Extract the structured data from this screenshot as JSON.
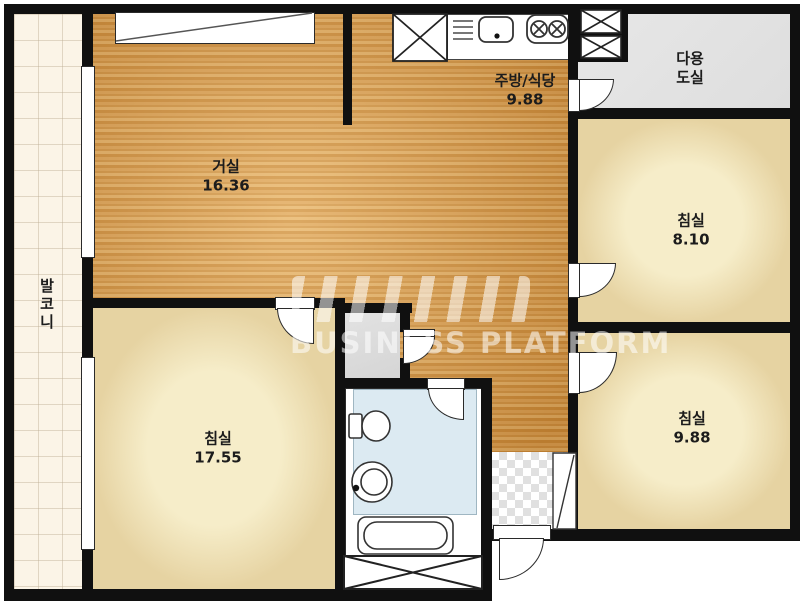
{
  "floorplan": {
    "watermark": {
      "brand_logo": "NHN",
      "brand_text": "BUSINESS PLATFORM"
    },
    "rooms": {
      "balcony": {
        "name": "발코니"
      },
      "living_room": {
        "name": "거실",
        "area": "16.36"
      },
      "kitchen_dining": {
        "name": "주방/식당",
        "area": "9.88"
      },
      "utility_room": {
        "name_line1": "다용",
        "name_line2": "도실"
      },
      "bedroom_right_top": {
        "name": "침실",
        "area": "8.10"
      },
      "bedroom_right_bottom": {
        "name": "침실",
        "area": "9.88"
      },
      "bedroom_left": {
        "name": "침실",
        "area": "17.55"
      }
    },
    "fixtures": [
      "wardrobe",
      "refrigerator-space",
      "range-hood",
      "kitchen-sink",
      "stove",
      "duct-shaft-upper",
      "duct-shaft-lower",
      "toilet",
      "wash-basin",
      "bathtub",
      "shoe-cabinet",
      "storage-closet",
      "entrance-door",
      "balcony-window-top",
      "balcony-window-bottom"
    ],
    "colors": {
      "wall": "#101010",
      "wood_floor": "#d79a47",
      "bedroom_floor": "#f0e3ba",
      "balcony_floor": "#fbf4e7",
      "utility_floor": "#e4e4e4",
      "bathroom_floor": "#dceaf2",
      "dressing_floor": "#dcdcdc",
      "entrance_checker": "#e0e0e0"
    }
  }
}
